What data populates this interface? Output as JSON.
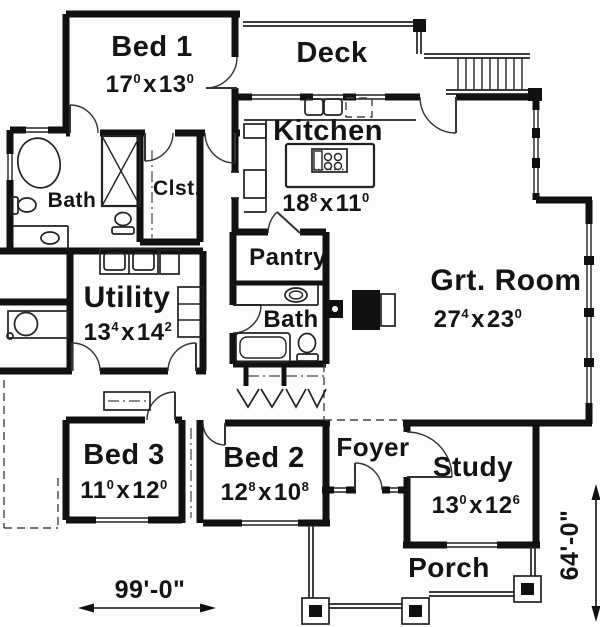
{
  "plan": {
    "rooms": {
      "bed1": {
        "name": "Bed 1",
        "dim": {
          "ft1": "17",
          "in1": "0",
          "ft2": "13",
          "in2": "0"
        }
      },
      "deck": {
        "name": "Deck"
      },
      "kitchen": {
        "name": "Kitchen",
        "dim": {
          "ft1": "18",
          "in1": "8",
          "ft2": "11",
          "in2": "0"
        }
      },
      "bath_master": {
        "name": "Bath"
      },
      "closet": {
        "name": "Clst."
      },
      "pantry": {
        "name": "Pantry"
      },
      "bath_hall": {
        "name": "Bath"
      },
      "utility": {
        "name": "Utility",
        "dim": {
          "ft1": "13",
          "in1": "4",
          "ft2": "14",
          "in2": "2"
        }
      },
      "great_room": {
        "name": "Grt. Room",
        "dim": {
          "ft1": "27",
          "in1": "4",
          "ft2": "23",
          "in2": "0"
        }
      },
      "bed3": {
        "name": "Bed 3",
        "dim": {
          "ft1": "11",
          "in1": "0",
          "ft2": "12",
          "in2": "0"
        }
      },
      "bed2": {
        "name": "Bed 2",
        "dim": {
          "ft1": "12",
          "in1": "8",
          "ft2": "10",
          "in2": "8"
        }
      },
      "foyer": {
        "name": "Foyer"
      },
      "study": {
        "name": "Study",
        "dim": {
          "ft1": "13",
          "in1": "0",
          "ft2": "12",
          "in2": "6"
        }
      },
      "porch": {
        "name": "Porch"
      }
    },
    "annotations": {
      "overall_width": "99'-0\"",
      "overall_height": "64'-0\"",
      "dim_separator": "x"
    },
    "colors": {
      "wall": "#111111",
      "line": "#222222",
      "background": "#fdfdfd"
    }
  }
}
